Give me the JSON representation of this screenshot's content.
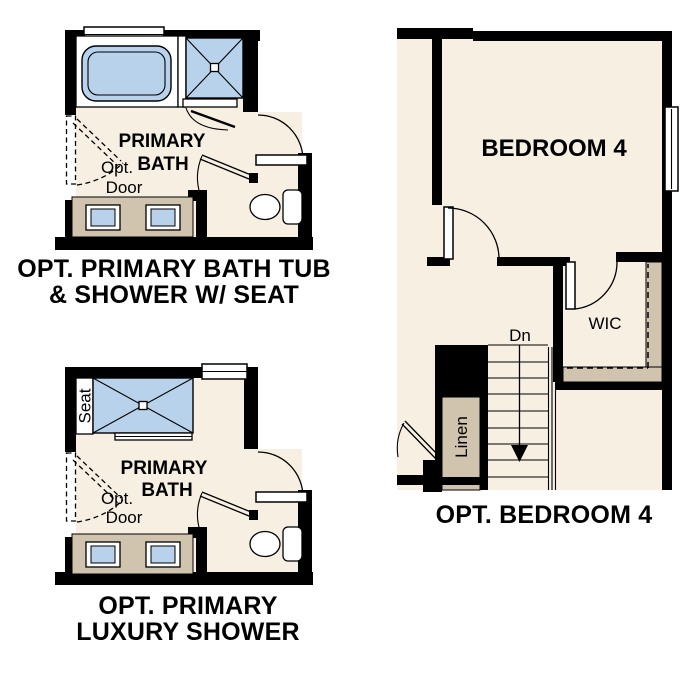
{
  "colors": {
    "paper": "#ffffff",
    "wall": "#000000",
    "floor": "#f6efe2",
    "cabinet": "#d0c4ae",
    "fixture": "#b7d2ea"
  },
  "plans": {
    "bath_tub": {
      "room_label_line1": "PRIMARY",
      "room_label_line2": "BATH",
      "opt_door_label_line1": "Opt.",
      "opt_door_label_line2": "Door",
      "caption_line1": "OPT. PRIMARY BATH TUB",
      "caption_line2": "& SHOWER W/ SEAT"
    },
    "luxury_shower": {
      "room_label_line1": "PRIMARY",
      "room_label_line2": "BATH",
      "seat_label": "Seat",
      "opt_door_label_line1": "Opt.",
      "opt_door_label_line2": "Door",
      "caption_line1": "OPT. PRIMARY",
      "caption_line2": "LUXURY SHOWER"
    },
    "bedroom4": {
      "room_label": "BEDROOM 4",
      "closet_label": "WIC",
      "stairs_label": "Dn",
      "linen_label": "Linen",
      "caption": "OPT. BEDROOM 4"
    }
  }
}
